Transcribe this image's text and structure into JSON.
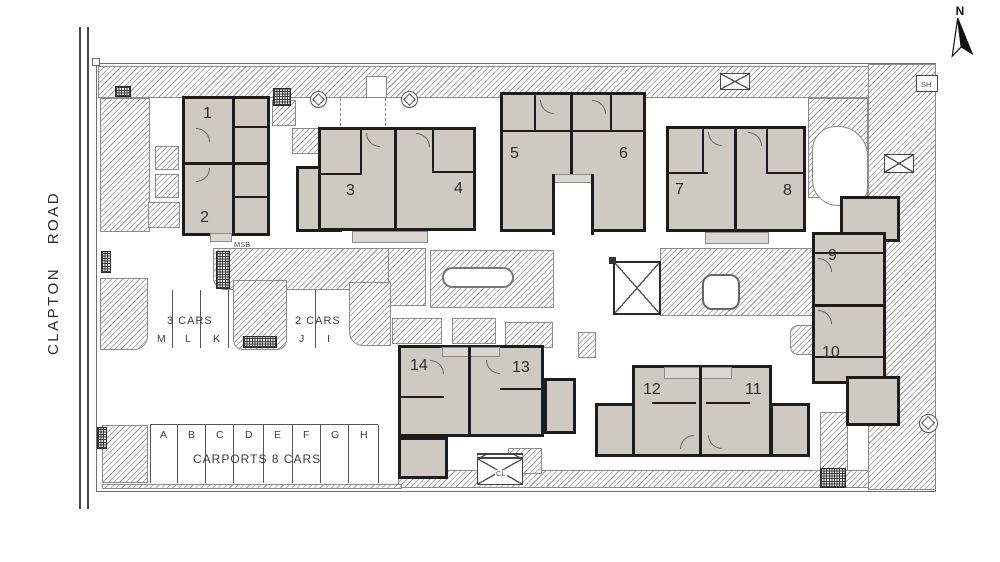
{
  "road": {
    "label": "CLAPTON ROAD"
  },
  "compass": {
    "label": "N"
  },
  "units": [
    {
      "label": "1"
    },
    {
      "label": "2"
    },
    {
      "label": "3"
    },
    {
      "label": "4"
    },
    {
      "label": "5"
    },
    {
      "label": "6"
    },
    {
      "label": "7"
    },
    {
      "label": "8"
    },
    {
      "label": "9"
    },
    {
      "label": "10"
    },
    {
      "label": "11"
    },
    {
      "label": "12"
    },
    {
      "label": "13"
    },
    {
      "label": "14"
    }
  ],
  "annotations": {
    "msb": "MSB",
    "sh": "SH",
    "cl": "CL"
  },
  "parking": {
    "top_left": {
      "title": "3 CARS",
      "stalls": [
        "M",
        "L",
        "K"
      ]
    },
    "top_right": {
      "title": "2 CARS",
      "stalls": [
        "J",
        "I"
      ]
    },
    "bottom": {
      "title": "CARPORTS  8  CARS",
      "stalls": [
        "A",
        "B",
        "C",
        "D",
        "E",
        "F",
        "G",
        "H"
      ]
    }
  },
  "colors": {
    "building_fill": "#cfc9c2",
    "wall": "#1c1c1c",
    "hatch": "#9a9a9a",
    "line": "#555555",
    "background": "#ffffff"
  }
}
